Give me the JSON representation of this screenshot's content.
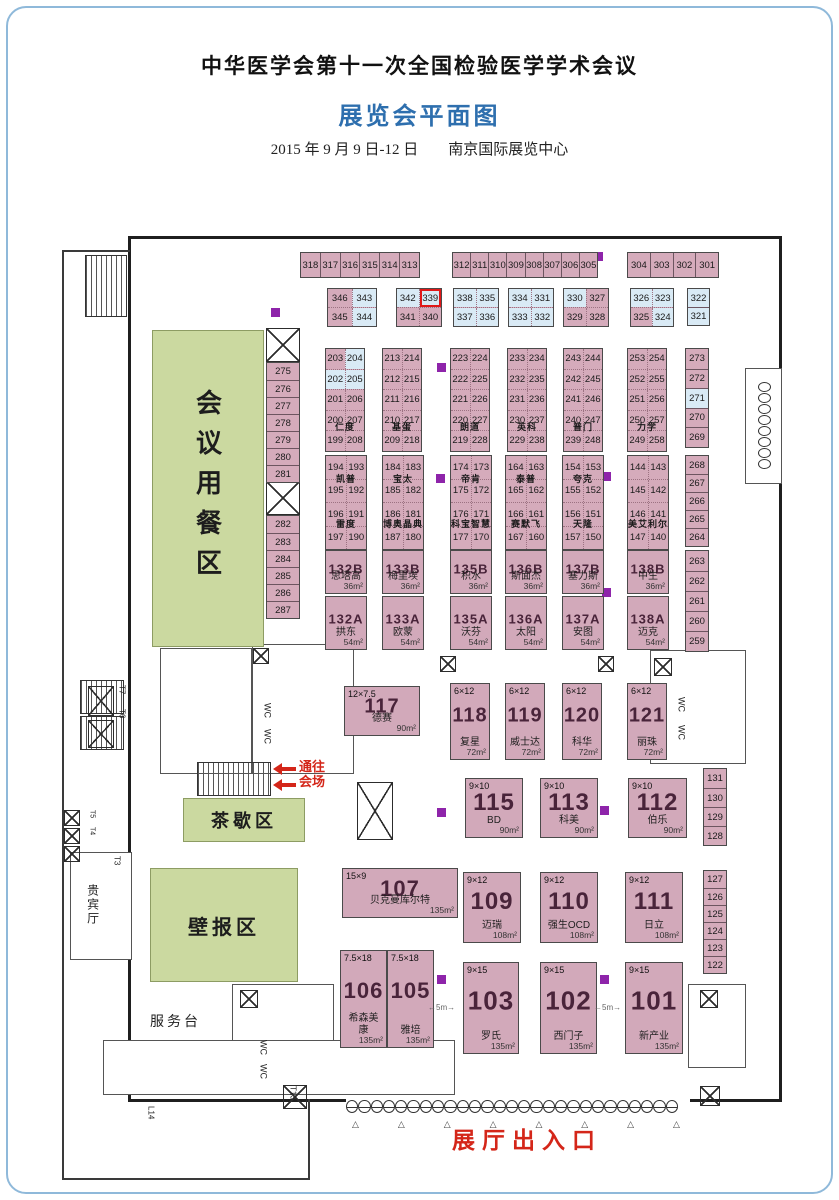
{
  "header": {
    "title": "中华医学会第十一次全国检验医学学术会议",
    "subtitle": "展览会平面图",
    "date_venue": "2015 年 9 月 9 日-12 日　　南京国际展览中心"
  },
  "colors": {
    "booth_pink": "#d5abbb",
    "booth_blue": "#d9eaf5",
    "zone_green": "#cbd9a0",
    "accent_blue": "#2e6fae",
    "red": "#d42619",
    "pillar_purple": "#8e24aa",
    "highlight_booth": "339"
  },
  "to_hall": {
    "line1": "通往",
    "line2": "会场"
  },
  "entrance": {
    "label": "展厅出入口",
    "doors": 27,
    "triangles": 8
  },
  "zones": [
    {
      "name": "dining-zone",
      "label": "会议用餐区",
      "vertical": true,
      "x": 152,
      "y": 330,
      "w": 112,
      "h": 317,
      "fs": 26
    },
    {
      "name": "tea-break-zone",
      "label": "茶歇区",
      "x": 183,
      "y": 798,
      "w": 122,
      "h": 44,
      "fs": 18
    },
    {
      "name": "poster-zone",
      "label": "壁报区",
      "x": 150,
      "y": 868,
      "w": 148,
      "h": 114,
      "fs": 20
    }
  ],
  "labels": [
    {
      "name": "hall-entrance-label",
      "t": "展厅出入口",
      "x": 452,
      "y": 1128,
      "fs": 23,
      "color": "#d42619",
      "bold": 1,
      "ls": 7
    },
    {
      "name": "service-desk-label",
      "t": "服务台",
      "x": 150,
      "y": 1014,
      "fs": 14,
      "ls": 3
    },
    {
      "name": "vip-room-label",
      "t": "贵宾厅",
      "x": 86,
      "y": 884,
      "fs": 12,
      "vert": 1,
      "ls": 2
    },
    {
      "name": "wc-label",
      "t": "WC",
      "x": 262,
      "y": 703,
      "fs": 9,
      "vert": 1
    },
    {
      "name": "wc-label",
      "t": "WC",
      "x": 262,
      "y": 729,
      "fs": 9,
      "vert": 1
    },
    {
      "name": "wc-label",
      "t": "WC",
      "x": 676,
      "y": 697,
      "fs": 9,
      "vert": 1
    },
    {
      "name": "wc-label",
      "t": "WC",
      "x": 676,
      "y": 725,
      "fs": 9,
      "vert": 1
    },
    {
      "name": "wc-label",
      "t": "WC",
      "x": 258,
      "y": 1040,
      "fs": 9,
      "vert": 1
    },
    {
      "name": "wc-label",
      "t": "WC",
      "x": 258,
      "y": 1064,
      "fs": 9,
      "vert": 1
    },
    {
      "name": "elevator-t7-label",
      "t": "T7",
      "x": 117,
      "y": 685,
      "fs": 8,
      "vert": 1
    },
    {
      "name": "elevator-t6-label",
      "t": "T6",
      "x": 117,
      "y": 709,
      "fs": 8,
      "vert": 1
    },
    {
      "name": "elevator-t5-label",
      "t": "T5",
      "x": 88,
      "y": 810,
      "fs": 7,
      "vert": 1
    },
    {
      "name": "elevator-t4-label",
      "t": "T4",
      "x": 88,
      "y": 827,
      "fs": 7,
      "vert": 1
    },
    {
      "name": "elevator-t3-label",
      "t": "T3",
      "x": 112,
      "y": 856,
      "fs": 8,
      "vert": 1
    },
    {
      "name": "elevator-t13-label",
      "t": "T13",
      "x": 288,
      "y": 1086,
      "fs": 8,
      "vert": 1
    },
    {
      "name": "dock-l14-label",
      "t": "L14",
      "x": 146,
      "y": 1106,
      "fs": 8,
      "vert": 1
    },
    {
      "name": "gap-5m-label",
      "t": "←5m→",
      "x": 428,
      "y": 1004,
      "fs": 8,
      "color": "#666"
    },
    {
      "name": "gap-5m-label",
      "t": "←5m→",
      "x": 594,
      "y": 1004,
      "fs": 8,
      "color": "#666"
    }
  ],
  "pillars": [
    [
      271,
      308
    ],
    [
      594,
      252
    ],
    [
      437,
      363
    ],
    [
      436,
      474
    ],
    [
      602,
      472
    ],
    [
      602,
      588
    ],
    [
      437,
      808
    ],
    [
      600,
      806
    ],
    [
      437,
      975
    ],
    [
      600,
      975
    ]
  ],
  "booth_groups": [
    {
      "type": "hstrip",
      "x": 300,
      "y": 252,
      "w": 120,
      "h": 26,
      "cells": [
        "318",
        "317",
        "316",
        "315",
        "314",
        "313"
      ]
    },
    {
      "type": "hstrip",
      "x": 452,
      "y": 252,
      "w": 146,
      "h": 26,
      "cells": [
        "312",
        "311",
        "310",
        "309",
        "308",
        "307",
        "306",
        "305"
      ]
    },
    {
      "type": "hstrip",
      "x": 627,
      "y": 252,
      "w": 92,
      "h": 26,
      "cells": [
        "304",
        "303",
        "302",
        "301"
      ]
    },
    {
      "type": "grid",
      "x": 327,
      "y": 288,
      "w": 50,
      "cellH": 18,
      "rows": [
        [
          "346",
          "343"
        ],
        [
          "345",
          "344"
        ]
      ],
      "blue": [
        "343",
        "344"
      ]
    },
    {
      "type": "grid",
      "x": 396,
      "y": 288,
      "w": 46,
      "cellH": 18,
      "rows": [
        [
          "342",
          "339"
        ],
        [
          "341",
          "340"
        ]
      ],
      "blue": [
        "342",
        "339"
      ],
      "hl": [
        "339"
      ]
    },
    {
      "type": "grid",
      "x": 453,
      "y": 288,
      "w": 46,
      "cellH": 18,
      "rows": [
        [
          "338",
          "335"
        ],
        [
          "337",
          "336"
        ]
      ],
      "blue": [
        "338",
        "335",
        "337",
        "336"
      ]
    },
    {
      "type": "grid",
      "x": 508,
      "y": 288,
      "w": 46,
      "cellH": 18,
      "rows": [
        [
          "334",
          "331"
        ],
        [
          "333",
          "332"
        ]
      ],
      "blue": [
        "334",
        "331",
        "333",
        "332"
      ]
    },
    {
      "type": "grid",
      "x": 563,
      "y": 288,
      "w": 46,
      "cellH": 18,
      "rows": [
        [
          "330",
          "327"
        ],
        [
          "329",
          "328"
        ]
      ],
      "blue": [
        "330"
      ]
    },
    {
      "type": "grid",
      "x": 630,
      "y": 288,
      "w": 44,
      "cellH": 18,
      "rows": [
        [
          "326",
          "323"
        ],
        [
          "325",
          "324"
        ]
      ],
      "blue": [
        "326",
        "323",
        "324"
      ]
    },
    {
      "type": "vstrip",
      "x": 687,
      "y": 288,
      "w": 23,
      "cellH": 18,
      "cells": [
        {
          "n": "322",
          "c": "blue"
        },
        {
          "n": "321",
          "c": "blue"
        }
      ]
    },
    {
      "type": "grid",
      "x": 325,
      "y": 348,
      "w": 40,
      "cellH": 19.5,
      "rows": [
        [
          "203",
          "204"
        ],
        [
          "202",
          "205"
        ],
        [
          "201",
          "206"
        ],
        [
          "200",
          "207"
        ],
        [
          "199",
          "208"
        ]
      ],
      "blue": [
        "204",
        "202",
        "205"
      ],
      "names": [
        {
          "t": "仁度",
          "after": 3
        }
      ]
    },
    {
      "type": "grid",
      "x": 382,
      "y": 348,
      "w": 40,
      "cellH": 19.5,
      "rows": [
        [
          "213",
          "214"
        ],
        [
          "212",
          "215"
        ],
        [
          "211",
          "216"
        ],
        [
          "210",
          "217"
        ],
        [
          "209",
          "218"
        ]
      ],
      "names": [
        {
          "t": "基蛋",
          "after": 3
        }
      ]
    },
    {
      "type": "grid",
      "x": 450,
      "y": 348,
      "w": 40,
      "cellH": 19.5,
      "rows": [
        [
          "223",
          "224"
        ],
        [
          "222",
          "225"
        ],
        [
          "221",
          "226"
        ],
        [
          "220",
          "227"
        ],
        [
          "219",
          "228"
        ]
      ],
      "names": [
        {
          "t": "朗道",
          "after": 3
        }
      ]
    },
    {
      "type": "grid",
      "x": 507,
      "y": 348,
      "w": 40,
      "cellH": 19.5,
      "rows": [
        [
          "233",
          "234"
        ],
        [
          "232",
          "235"
        ],
        [
          "231",
          "236"
        ],
        [
          "230",
          "237"
        ],
        [
          "229",
          "238"
        ]
      ],
      "names": [
        {
          "t": "英科",
          "after": 3
        }
      ]
    },
    {
      "type": "grid",
      "x": 563,
      "y": 348,
      "w": 40,
      "cellH": 19.5,
      "rows": [
        [
          "243",
          "244"
        ],
        [
          "242",
          "245"
        ],
        [
          "241",
          "246"
        ],
        [
          "240",
          "247"
        ],
        [
          "239",
          "248"
        ]
      ],
      "names": [
        {
          "t": "普门",
          "after": 3
        }
      ]
    },
    {
      "type": "grid",
      "x": 627,
      "y": 348,
      "w": 40,
      "cellH": 19.5,
      "rows": [
        [
          "253",
          "254"
        ],
        [
          "252",
          "255"
        ],
        [
          "251",
          "256"
        ],
        [
          "250",
          "257"
        ],
        [
          "249",
          "258"
        ]
      ],
      "names": [
        {
          "t": "力学",
          "after": 3
        }
      ]
    },
    {
      "type": "vstrip",
      "x": 685,
      "y": 348,
      "w": 24,
      "cellH": 19.5,
      "cells": [
        "273",
        "272",
        {
          "n": "271",
          "c": "blue"
        },
        "270",
        "269"
      ]
    },
    {
      "type": "grid",
      "x": 325,
      "y": 455,
      "w": 42,
      "cellH": 22.5,
      "rows": [
        [
          "194",
          "193"
        ],
        [
          "195",
          "192"
        ],
        [
          "196",
          "191"
        ],
        [
          "197",
          "190"
        ]
      ],
      "names": [
        {
          "t": "凯普",
          "after": 0
        },
        {
          "t": "雷度",
          "after": 2
        }
      ]
    },
    {
      "type": "grid",
      "x": 382,
      "y": 455,
      "w": 42,
      "cellH": 22.5,
      "rows": [
        [
          "184",
          "183"
        ],
        [
          "185",
          "182"
        ],
        [
          "186",
          "181"
        ],
        [
          "187",
          "180"
        ]
      ],
      "names": [
        {
          "t": "宝太",
          "after": 0
        },
        {
          "t": "博奥晶典",
          "after": 2
        }
      ]
    },
    {
      "type": "grid",
      "x": 450,
      "y": 455,
      "w": 42,
      "cellH": 22.5,
      "rows": [
        [
          "174",
          "173"
        ],
        [
          "175",
          "172"
        ],
        [
          "176",
          "171"
        ],
        [
          "177",
          "170"
        ]
      ],
      "names": [
        {
          "t": "帝肯",
          "after": 0
        },
        {
          "t": "科宝智慧",
          "after": 2
        }
      ]
    },
    {
      "type": "grid",
      "x": 505,
      "y": 455,
      "w": 42,
      "cellH": 22.5,
      "rows": [
        [
          "164",
          "163"
        ],
        [
          "165",
          "162"
        ],
        [
          "166",
          "161"
        ],
        [
          "167",
          "160"
        ]
      ],
      "names": [
        {
          "t": "泰普",
          "after": 0
        },
        {
          "t": "赛默飞",
          "after": 2
        }
      ]
    },
    {
      "type": "grid",
      "x": 562,
      "y": 455,
      "w": 42,
      "cellH": 22.5,
      "rows": [
        [
          "154",
          "153"
        ],
        [
          "155",
          "152"
        ],
        [
          "156",
          "151"
        ],
        [
          "157",
          "150"
        ]
      ],
      "names": [
        {
          "t": "夸克",
          "after": 0
        },
        {
          "t": "天隆",
          "after": 2
        }
      ]
    },
    {
      "type": "grid",
      "x": 627,
      "y": 455,
      "w": 42,
      "cellH": 22.5,
      "rows": [
        [
          "144",
          "143"
        ],
        [
          "145",
          "142"
        ],
        [
          "146",
          "141"
        ],
        [
          "147",
          "140"
        ]
      ],
      "names": [
        {
          "t": "美艾利尔",
          "after": 2
        }
      ]
    },
    {
      "type": "vstrip",
      "x": 685,
      "y": 455,
      "w": 24,
      "cellH": 18,
      "cells": [
        "268",
        "267",
        "266",
        "265",
        "264"
      ]
    },
    {
      "type": "booth",
      "x": 325,
      "y": 550,
      "w": 42,
      "h": 44,
      "num": "132B",
      "name": "思塔高",
      "area": "36m²",
      "nfs": 13
    },
    {
      "type": "booth",
      "x": 325,
      "y": 596,
      "w": 42,
      "h": 54,
      "num": "132A",
      "name": "拱东",
      "area": "54m²",
      "nfs": 13
    },
    {
      "type": "booth",
      "x": 382,
      "y": 550,
      "w": 42,
      "h": 44,
      "num": "133B",
      "name": "梅里埃",
      "area": "36m²",
      "nfs": 13
    },
    {
      "type": "booth",
      "x": 382,
      "y": 596,
      "w": 42,
      "h": 54,
      "num": "133A",
      "name": "欧蒙",
      "area": "54m²",
      "nfs": 13
    },
    {
      "type": "booth",
      "x": 450,
      "y": 550,
      "w": 42,
      "h": 44,
      "num": "135B",
      "name": "积水",
      "area": "36m²",
      "nfs": 13
    },
    {
      "type": "booth",
      "x": 450,
      "y": 596,
      "w": 42,
      "h": 54,
      "num": "135A",
      "name": "沃芬",
      "area": "54m²",
      "nfs": 13
    },
    {
      "type": "booth",
      "x": 505,
      "y": 550,
      "w": 42,
      "h": 44,
      "num": "136B",
      "name": "斯面杰",
      "area": "36m²",
      "nfs": 13
    },
    {
      "type": "booth",
      "x": 505,
      "y": 596,
      "w": 42,
      "h": 54,
      "num": "136A",
      "name": "太阳",
      "area": "54m²",
      "nfs": 13
    },
    {
      "type": "booth",
      "x": 562,
      "y": 550,
      "w": 42,
      "h": 44,
      "num": "137B",
      "name": "塞力斯",
      "area": "36m²",
      "nfs": 13
    },
    {
      "type": "booth",
      "x": 562,
      "y": 596,
      "w": 42,
      "h": 54,
      "num": "137A",
      "name": "安图",
      "area": "54m²",
      "nfs": 13
    },
    {
      "type": "booth",
      "x": 627,
      "y": 550,
      "w": 42,
      "h": 44,
      "num": "138B",
      "name": "中生",
      "area": "36m²",
      "nfs": 13
    },
    {
      "type": "booth",
      "x": 627,
      "y": 596,
      "w": 42,
      "h": 54,
      "num": "138A",
      "name": "迈克",
      "area": "54m²",
      "nfs": 13
    },
    {
      "type": "vstrip",
      "x": 685,
      "y": 550,
      "w": 24,
      "cellH": 20,
      "cells": [
        "263",
        "262",
        "261",
        "260",
        "259"
      ]
    },
    {
      "type": "vstrip",
      "x": 266,
      "y": 362,
      "w": 34,
      "cellH": 17,
      "cells": [
        "275",
        "276",
        "277",
        "278",
        "279",
        "280",
        "281"
      ]
    },
    {
      "type": "vstrip",
      "x": 266,
      "y": 515,
      "w": 34,
      "cellH": 17,
      "cells": [
        "282",
        "283",
        "284",
        "285",
        "286",
        "287"
      ]
    },
    {
      "type": "booth",
      "x": 344,
      "y": 686,
      "w": 76,
      "h": 50,
      "dim": "12×7.5",
      "num": "117",
      "name": "德赛",
      "area": "90m²",
      "nfs": 20
    },
    {
      "type": "booth",
      "x": 450,
      "y": 683,
      "w": 40,
      "h": 77,
      "dim": "6×12",
      "num": "118",
      "name": "复星",
      "area": "72m²",
      "nfs": 20
    },
    {
      "type": "booth",
      "x": 505,
      "y": 683,
      "w": 40,
      "h": 77,
      "dim": "6×12",
      "num": "119",
      "name": "威士达",
      "area": "72m²",
      "nfs": 20
    },
    {
      "type": "booth",
      "x": 562,
      "y": 683,
      "w": 40,
      "h": 77,
      "dim": "6×12",
      "num": "120",
      "name": "科华",
      "area": "72m²",
      "nfs": 20
    },
    {
      "type": "booth",
      "x": 627,
      "y": 683,
      "w": 40,
      "h": 77,
      "dim": "6×12",
      "num": "121",
      "name": "丽珠",
      "area": "72m²",
      "nfs": 20
    },
    {
      "type": "booth",
      "x": 465,
      "y": 778,
      "w": 58,
      "h": 60,
      "dim": "9×10",
      "num": "115",
      "name": "BD",
      "area": "90m²",
      "nfs": 24
    },
    {
      "type": "booth",
      "x": 540,
      "y": 778,
      "w": 58,
      "h": 60,
      "dim": "9×10",
      "num": "113",
      "name": "科美",
      "area": "90m²",
      "nfs": 24
    },
    {
      "type": "booth",
      "x": 628,
      "y": 778,
      "w": 59,
      "h": 60,
      "dim": "9×10",
      "num": "112",
      "name": "伯乐",
      "area": "90m²",
      "nfs": 24
    },
    {
      "type": "vstrip",
      "x": 703,
      "y": 768,
      "w": 24,
      "cellH": 19,
      "cells": [
        "131",
        "130",
        "129",
        "128"
      ]
    },
    {
      "type": "booth",
      "x": 342,
      "y": 868,
      "w": 116,
      "h": 50,
      "dim": "15×9",
      "num": "107",
      "name": "贝克曼库尔特",
      "area": "135m²",
      "nfs": 22
    },
    {
      "type": "booth",
      "x": 463,
      "y": 872,
      "w": 58,
      "h": 71,
      "dim": "9×12",
      "num": "109",
      "name": "迈瑞",
      "area": "108m²",
      "nfs": 24
    },
    {
      "type": "booth",
      "x": 540,
      "y": 872,
      "w": 58,
      "h": 71,
      "dim": "9×12",
      "num": "110",
      "name": "强生OCD",
      "area": "108m²",
      "nfs": 24
    },
    {
      "type": "booth",
      "x": 625,
      "y": 872,
      "w": 58,
      "h": 71,
      "dim": "9×12",
      "num": "111",
      "name": "日立",
      "area": "108m²",
      "nfs": 24
    },
    {
      "type": "vstrip",
      "x": 703,
      "y": 870,
      "w": 24,
      "cellH": 17,
      "cells": [
        "127",
        "126",
        "125",
        "124",
        "123",
        "122"
      ]
    },
    {
      "type": "booth",
      "x": 340,
      "y": 950,
      "w": 47,
      "h": 98,
      "dim": "7.5×18",
      "num": "106",
      "name": "希森美康",
      "area": "135m²",
      "nfs": 22
    },
    {
      "type": "booth",
      "x": 387,
      "y": 950,
      "w": 47,
      "h": 98,
      "dim": "7.5×18",
      "num": "105",
      "name": "雅培",
      "area": "135m²",
      "nfs": 22
    },
    {
      "type": "booth",
      "x": 463,
      "y": 962,
      "w": 56,
      "h": 92,
      "dim": "9×15",
      "num": "103",
      "name": "罗氏",
      "area": "135m²",
      "nfs": 26
    },
    {
      "type": "booth",
      "x": 540,
      "y": 962,
      "w": 57,
      "h": 92,
      "dim": "9×15",
      "num": "102",
      "name": "西门子",
      "area": "135m²",
      "nfs": 26
    },
    {
      "type": "booth",
      "x": 625,
      "y": 962,
      "w": 58,
      "h": 92,
      "dim": "9×15",
      "num": "101",
      "name": "新产业",
      "area": "135m²",
      "nfs": 26
    }
  ]
}
